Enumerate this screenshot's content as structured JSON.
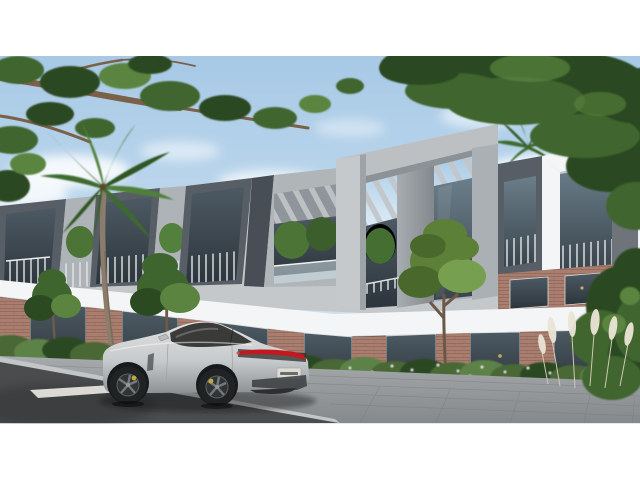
{
  "meta": {
    "description": "Photorealistic 3D architectural rendering of a modern two-storey townhouse complex with grey concrete frames, pergola roof slats, glass balconies and brick ground-floor storefronts; a silver electric sports sedan is parked on the street in the foreground, framed by an overhanging tree branch, dense foliage and a palm tree under a blue sky with clouds",
    "image_type": "architectural exterior visualization, letterboxed with white bands top and bottom",
    "visible_text": "none (rear license plate present but illegible)"
  },
  "palette": {
    "page_bg": "#ffffff",
    "sky_top": "#a7c9e6",
    "sky_bottom": "#dcebf5",
    "cloud": "#ffffff",
    "foliage_dark": "#2c4a21",
    "foliage_mid": "#3f652e",
    "foliage_light": "#5a8440",
    "branch_brown": "#7b6148",
    "palm_green": "#3e6a2d",
    "palm_trunk": "#8b7c6b",
    "concrete_light": "#c4c8cb",
    "concrete_mid": "#a7acb0",
    "panel_dark": "#575e65",
    "white_trim": "#f4f5f6",
    "glass_dark": "#38434b",
    "brick": "#a97e6f",
    "brick_dark": "#8d675a",
    "hedge_green": "#486836",
    "grass_plume": "#eae5d6",
    "sidewalk": "#9aa0a2",
    "curb": "#c2c6c8",
    "road": "#4a4c4e",
    "lane_marking": "#e8e6e0",
    "car_body_light": "#e0e2e3",
    "car_body": "#c7cacc",
    "car_body_dark": "#8e9294",
    "car_glass": "#3a3b38",
    "taillight_red": "#c2191f",
    "wheel_dark": "#202223",
    "caliper_yellow": "#d2b33a",
    "plate_white": "#dcdcd6"
  },
  "scene": {
    "sky": {
      "label": "daytime blue sky with scattered white clouds"
    },
    "vegetation": {
      "canopy_left": "overhanging brown branch with green leaf clusters, top-left",
      "canopy_right": "dense dark-green tree mass, top-right",
      "palm": "tall palm tree in front of the building, left-center",
      "street_trees": "small ornamental trees along the facade",
      "hedge": "low shrub hedge with white ornamental grasses along the sidewalk"
    },
    "building": {
      "label": "modern residential complex, two storeys",
      "features": "grey concrete frames, rooftop pergola slats, glass balconies with railings, white fascia band, brick ground floor with dark storefront glazing"
    },
    "car": {
      "label": "silver electric sports sedan, rear three-quarter view facing left",
      "details": "full-width red taillight bar, dark five-spoke wheels, yellow brake calipers, illegible white rear license plate"
    },
    "street": {
      "label": "dark asphalt road with white dashed lane marking, light grey paver sidewalk and curb"
    }
  }
}
